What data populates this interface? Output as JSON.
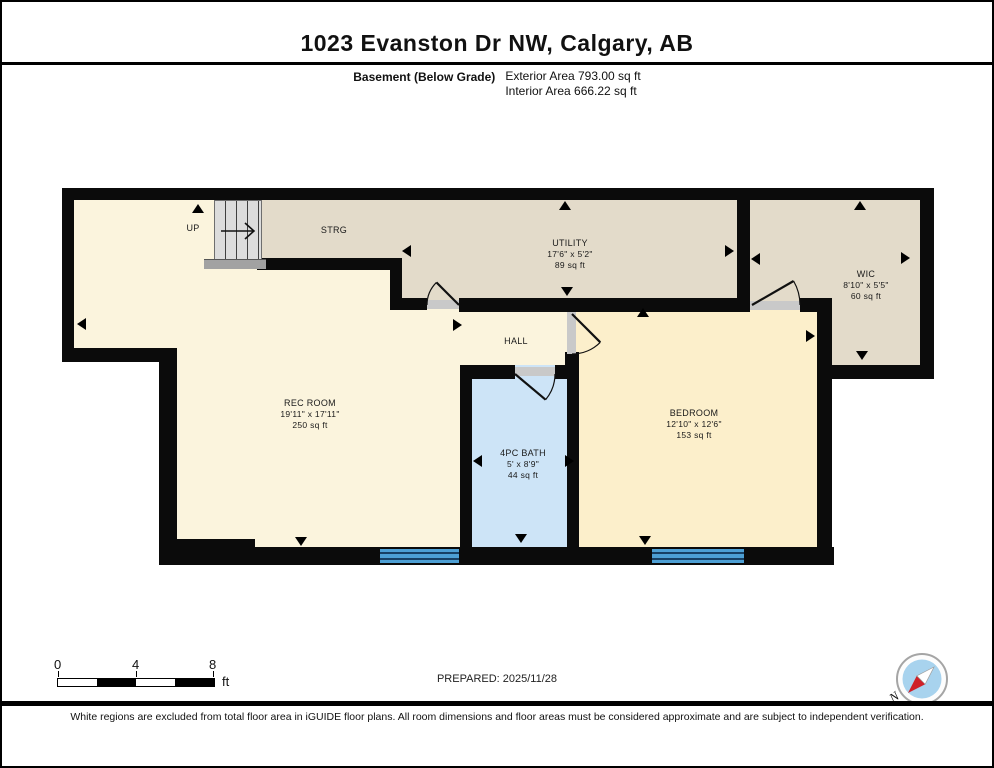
{
  "header": {
    "title": "1023 Evanston Dr NW, Calgary, AB",
    "floor_label": "Basement (Below Grade)",
    "exterior_area": "Exterior Area 793.00 sq ft",
    "interior_area": "Interior Area 666.22 sq ft"
  },
  "rooms": {
    "strg": {
      "name": "STRG"
    },
    "utility": {
      "name": "UTILITY",
      "dims": "17'6\" x 5'2\"",
      "area": "89 sq ft"
    },
    "wic": {
      "name": "WIC",
      "dims": "8'10\" x 5'5\"",
      "area": "60 sq ft"
    },
    "hall": {
      "name": "HALL"
    },
    "rec": {
      "name": "REC ROOM",
      "dims": "19'11\" x 17'11\"",
      "area": "250 sq ft"
    },
    "bath": {
      "name": "4PC BATH",
      "dims": "5' x 8'9\"",
      "area": "44 sq ft"
    },
    "bedroom": {
      "name": "BEDROOM",
      "dims": "12'10\" x 12'6\"",
      "area": "153 sq ft"
    }
  },
  "stairs": {
    "label": "UP"
  },
  "scale_bar": {
    "tick0": "0",
    "tick4": "4",
    "tick8": "8",
    "unit": "ft"
  },
  "prepared": "PREPARED: 2025/11/28",
  "compass": {
    "label": "N"
  },
  "footer": "White regions are excluded from total floor area in iGUIDE floor plans. All room dimensions and floor areas must be considered approximate and are subject to independent verification.",
  "colors": {
    "room_cream": "#fbf4dd",
    "room_cream_bedroom": "#fcefcb",
    "room_tan": "#e3dbca",
    "room_bath_blue": "#cde4f7",
    "window_blue": "#4d9fd4",
    "wall_black": "#0b0b0b",
    "compass_blue": "#a8d3ee",
    "compass_red": "#cf2027"
  }
}
